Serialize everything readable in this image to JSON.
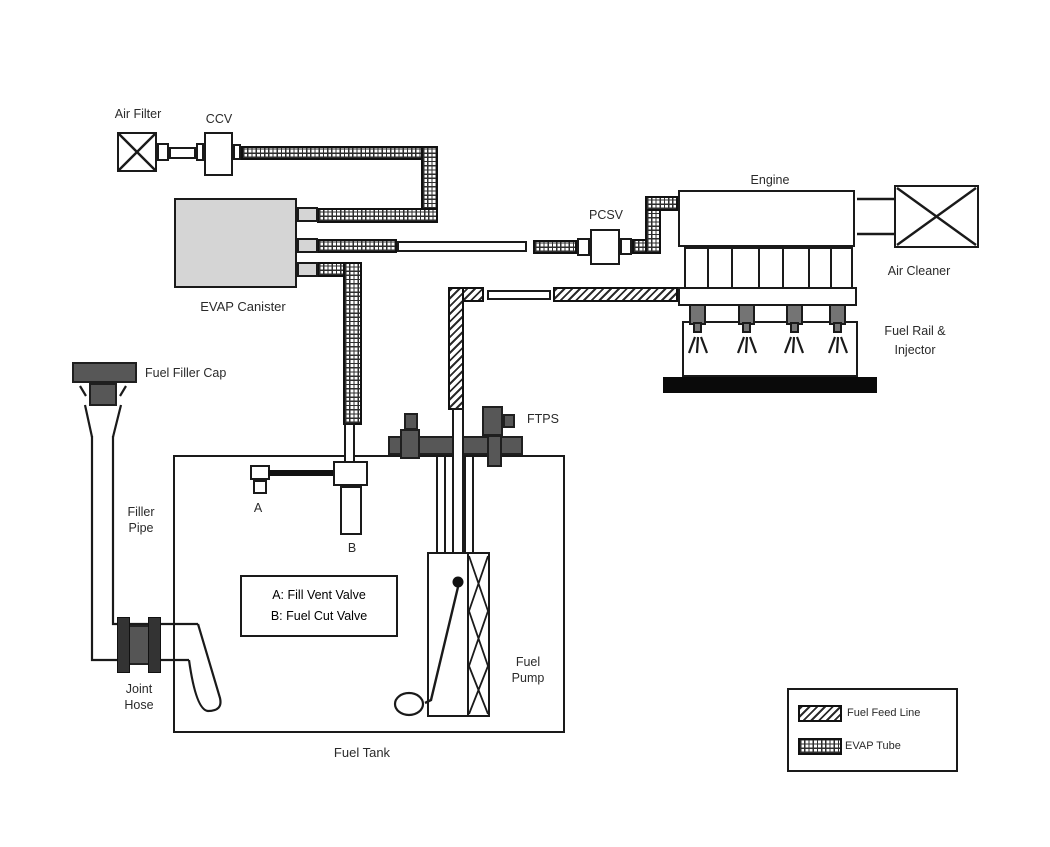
{
  "diagram": {
    "labels": {
      "air_filter": "Air Filter",
      "ccv": "CCV",
      "evap_canister": "EVAP Canister",
      "pcsv": "PCSV",
      "engine": "Engine",
      "air_cleaner": "Air Cleaner",
      "fuel_rail_line1": "Fuel Rail &",
      "fuel_rail_line2": "Injector",
      "ftps": "FTPS",
      "fuel_filler_cap": "Fuel Filler Cap",
      "filler_line1": "Filler",
      "filler_line2": "Pipe",
      "joint_line1": "Joint",
      "joint_line2": "Hose",
      "marker_a": "A",
      "marker_b": "B",
      "fuel_tank": "Fuel Tank",
      "fuel_pump_line1": "Fuel",
      "fuel_pump_line2": "Pump"
    },
    "note_box": {
      "line1": "A: Fill Vent Valve",
      "line2": "B: Fuel Cut Valve"
    },
    "legend": {
      "items": [
        {
          "label": "Fuel Feed Line",
          "pattern": "diagonal-hatch"
        },
        {
          "label": "EVAP Tube",
          "pattern": "grid-hatch"
        }
      ]
    },
    "colors": {
      "line": "#1a1a1a",
      "canister_fill": "#d5d5d5",
      "dark_component": "#575757",
      "injector_fill": "#747474",
      "hose_band": "#333333",
      "base_black": "#0a0a0a",
      "background": "#ffffff"
    }
  }
}
